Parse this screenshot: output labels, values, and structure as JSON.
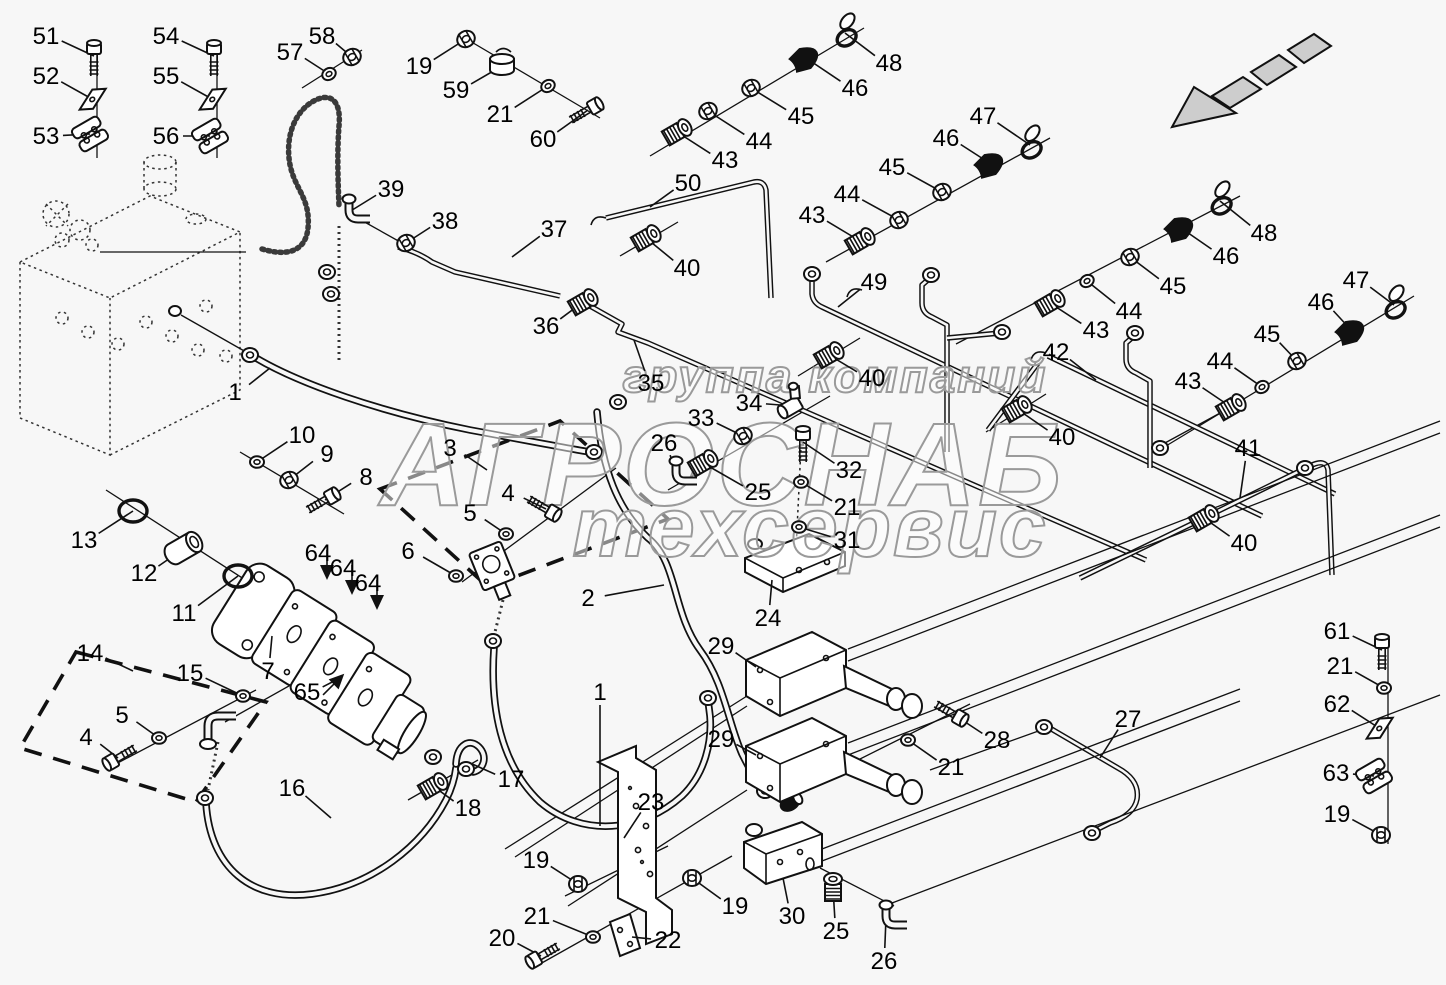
{
  "watermark": {
    "line1": "группа компаний",
    "line2": "АГРОСНАБ",
    "line3": "техсервис",
    "color": "#9a9a9a"
  },
  "colors": {
    "line": "#111111",
    "background": "#f7f7f7",
    "arrow_fill": "#cdcdcd"
  },
  "icons": {
    "direction_arrow": "travel-direction-arrow"
  },
  "callouts": [
    {
      "n": "51",
      "lx": 46,
      "ly": 36,
      "tx": 94,
      "ty": 56,
      "p": "bolt",
      "r": -90
    },
    {
      "n": "52",
      "lx": 46,
      "ly": 76,
      "tx": 92,
      "ty": 99,
      "p": "plate"
    },
    {
      "n": "53",
      "lx": 46,
      "ly": 136,
      "tx": 90,
      "ty": 134,
      "p": "clamp"
    },
    {
      "n": "54",
      "lx": 166,
      "ly": 36,
      "tx": 214,
      "ty": 56,
      "p": "bolt",
      "r": -90
    },
    {
      "n": "55",
      "lx": 166,
      "ly": 76,
      "tx": 212,
      "ty": 99,
      "p": "plate"
    },
    {
      "n": "56",
      "lx": 166,
      "ly": 136,
      "tx": 210,
      "ty": 136,
      "p": "clamp"
    },
    {
      "n": "57",
      "lx": 290,
      "ly": 52,
      "tx": 329,
      "ty": 74,
      "p": "washer"
    },
    {
      "n": "58",
      "lx": 322,
      "ly": 36,
      "tx": 352,
      "ty": 57,
      "p": "nut"
    },
    {
      "n": "19",
      "lx": 419,
      "ly": 66,
      "tx": 466,
      "ty": 39,
      "p": "nut"
    },
    {
      "n": "59",
      "lx": 456,
      "ly": 90,
      "tx": 502,
      "ty": 66,
      "p": "cap",
      "r": 0
    },
    {
      "n": "21",
      "lx": 500,
      "ly": 114,
      "tx": 548,
      "ty": 86,
      "p": "washer"
    },
    {
      "n": "60",
      "lx": 543,
      "ly": 139,
      "tx": 588,
      "ty": 110,
      "p": "bolt"
    },
    {
      "n": "39",
      "lx": 391,
      "ly": 189,
      "tx": 349,
      "ty": 212,
      "p": "elbow",
      "r": 0
    },
    {
      "n": "38",
      "lx": 445,
      "ly": 221,
      "tx": 406,
      "ty": 243,
      "p": "nut"
    },
    {
      "n": "37",
      "lx": 554,
      "ly": 229,
      "tx": 512,
      "ty": 257,
      "p": "none"
    },
    {
      "n": "36",
      "lx": 546,
      "ly": 326,
      "tx": 583,
      "ty": 302,
      "p": "fitting"
    },
    {
      "n": "35",
      "lx": 651,
      "ly": 383,
      "tx": 634,
      "ty": 340,
      "p": "none"
    },
    {
      "n": "50",
      "lx": 688,
      "ly": 183,
      "tx": 650,
      "ty": 207,
      "p": "none"
    },
    {
      "n": "43",
      "lx": 725,
      "ly": 160,
      "tx": 677,
      "ty": 132,
      "p": "fitting"
    },
    {
      "n": "44",
      "lx": 759,
      "ly": 141,
      "tx": 708,
      "ty": 111,
      "p": "nut"
    },
    {
      "n": "45",
      "lx": 801,
      "ly": 116,
      "tx": 751,
      "ty": 88,
      "p": "nut"
    },
    {
      "n": "46",
      "lx": 855,
      "ly": 88,
      "tx": 806,
      "ty": 58,
      "p": "cone"
    },
    {
      "n": "48",
      "lx": 889,
      "ly": 63,
      "tx": 845,
      "ty": 33,
      "p": "ring"
    },
    {
      "n": "40",
      "lx": 687,
      "ly": 268,
      "tx": 646,
      "ty": 238,
      "p": "fitting"
    },
    {
      "n": "43",
      "lx": 812,
      "ly": 215,
      "tx": 860,
      "ty": 241,
      "p": "fitting"
    },
    {
      "n": "44",
      "lx": 847,
      "ly": 194,
      "tx": 899,
      "ty": 220,
      "p": "nut"
    },
    {
      "n": "45",
      "lx": 892,
      "ly": 167,
      "tx": 942,
      "ty": 192,
      "p": "nut"
    },
    {
      "n": "46",
      "lx": 946,
      "ly": 138,
      "tx": 991,
      "ty": 164,
      "p": "cone"
    },
    {
      "n": "47",
      "lx": 983,
      "ly": 116,
      "tx": 1030,
      "ty": 145,
      "p": "ring"
    },
    {
      "n": "49",
      "lx": 874,
      "ly": 282,
      "tx": 838,
      "ty": 307,
      "p": "none"
    },
    {
      "n": "42",
      "lx": 1056,
      "ly": 352,
      "tx": 1096,
      "ty": 380,
      "p": "none"
    },
    {
      "n": "43",
      "lx": 1096,
      "ly": 330,
      "tx": 1050,
      "ty": 303,
      "p": "fitting"
    },
    {
      "n": "44",
      "lx": 1129,
      "ly": 311,
      "tx": 1087,
      "ty": 281,
      "p": "washer"
    },
    {
      "n": "45",
      "lx": 1173,
      "ly": 286,
      "tx": 1130,
      "ty": 257,
      "p": "nut"
    },
    {
      "n": "46",
      "lx": 1226,
      "ly": 256,
      "tx": 1181,
      "ty": 228,
      "p": "cone"
    },
    {
      "n": "48",
      "lx": 1264,
      "ly": 233,
      "tx": 1220,
      "ty": 201,
      "p": "ring"
    },
    {
      "n": "40",
      "lx": 872,
      "ly": 378,
      "tx": 829,
      "ty": 355,
      "p": "fitting"
    },
    {
      "n": "40",
      "lx": 1062,
      "ly": 437,
      "tx": 1017,
      "ty": 409,
      "p": "fitting"
    },
    {
      "n": "41",
      "lx": 1248,
      "ly": 448,
      "tx": 1240,
      "ty": 498,
      "p": "none"
    },
    {
      "n": "43",
      "lx": 1188,
      "ly": 381,
      "tx": 1231,
      "ty": 407,
      "p": "fitting"
    },
    {
      "n": "44",
      "lx": 1220,
      "ly": 361,
      "tx": 1262,
      "ty": 387,
      "p": "washer"
    },
    {
      "n": "45",
      "lx": 1267,
      "ly": 334,
      "tx": 1297,
      "ty": 361,
      "p": "nut"
    },
    {
      "n": "46",
      "lx": 1321,
      "ly": 302,
      "tx": 1352,
      "ty": 331,
      "p": "cone"
    },
    {
      "n": "47",
      "lx": 1356,
      "ly": 280,
      "tx": 1394,
      "ty": 305,
      "p": "ring"
    },
    {
      "n": "40",
      "lx": 1244,
      "ly": 543,
      "tx": 1204,
      "ty": 518,
      "p": "fitting"
    },
    {
      "n": "34",
      "lx": 749,
      "ly": 403,
      "tx": 793,
      "ty": 406,
      "p": "tee"
    },
    {
      "n": "33",
      "lx": 701,
      "ly": 418,
      "tx": 743,
      "ty": 436,
      "p": "nut"
    },
    {
      "n": "26",
      "lx": 664,
      "ly": 443,
      "tx": 676,
      "ty": 474,
      "p": "elbow",
      "r": 0
    },
    {
      "n": "25",
      "lx": 758,
      "ly": 492,
      "tx": 703,
      "ty": 463,
      "p": "fitting"
    },
    {
      "n": "32",
      "lx": 849,
      "ly": 470,
      "tx": 803,
      "ty": 442,
      "p": "bolt",
      "r": -90
    },
    {
      "n": "21",
      "lx": 847,
      "ly": 507,
      "tx": 801,
      "ty": 482,
      "p": "washer",
      "r": 0
    },
    {
      "n": "31",
      "lx": 847,
      "ly": 540,
      "tx": 799,
      "ty": 527,
      "p": "washer",
      "r": 0
    },
    {
      "n": "24",
      "lx": 768,
      "ly": 618,
      "tx": 772,
      "ty": 580,
      "p": "none"
    },
    {
      "n": "29",
      "lx": 721,
      "ly": 646,
      "tx": 756,
      "ty": 667,
      "p": "none"
    },
    {
      "n": "29",
      "lx": 721,
      "ly": 739,
      "tx": 756,
      "ty": 755,
      "p": "none"
    },
    {
      "n": "28",
      "lx": 997,
      "ly": 740,
      "tx": 953,
      "ty": 714,
      "p": "bolt",
      "r": 30
    },
    {
      "n": "21",
      "lx": 951,
      "ly": 767,
      "tx": 908,
      "ty": 740,
      "p": "washer",
      "r": 0
    },
    {
      "n": "27",
      "lx": 1128,
      "ly": 719,
      "tx": 1100,
      "ty": 758,
      "p": "none"
    },
    {
      "n": "2",
      "lx": 588,
      "ly": 598,
      "tx": 664,
      "ty": 585,
      "p": "none"
    },
    {
      "n": "1",
      "lx": 600,
      "ly": 692,
      "tx": 600,
      "ty": 826,
      "p": "none"
    },
    {
      "n": "1",
      "lx": 235,
      "ly": 392,
      "tx": 270,
      "ty": 368,
      "p": "none"
    },
    {
      "n": "3",
      "lx": 450,
      "ly": 448,
      "tx": 487,
      "ty": 470,
      "p": "none"
    },
    {
      "n": "4",
      "lx": 508,
      "ly": 493,
      "tx": 546,
      "ty": 509,
      "p": "bolt",
      "r": 30
    },
    {
      "n": "5",
      "lx": 470,
      "ly": 513,
      "tx": 506,
      "ty": 534,
      "p": "washer",
      "r": 0
    },
    {
      "n": "6",
      "lx": 408,
      "ly": 551,
      "tx": 456,
      "ty": 576,
      "p": "washer",
      "r": 0
    },
    {
      "n": "10",
      "lx": 302,
      "ly": 435,
      "tx": 257,
      "ty": 462,
      "p": "washer",
      "r": 0
    },
    {
      "n": "9",
      "lx": 327,
      "ly": 454,
      "tx": 289,
      "ty": 480,
      "p": "nut"
    },
    {
      "n": "8",
      "lx": 366,
      "ly": 477,
      "tx": 325,
      "ty": 500,
      "p": "bolt"
    },
    {
      "n": "13",
      "lx": 84,
      "ly": 540,
      "tx": 133,
      "ty": 511,
      "p": "oring",
      "r": 0
    },
    {
      "n": "12",
      "lx": 144,
      "ly": 573,
      "tx": 189,
      "ty": 545,
      "p": "coupling"
    },
    {
      "n": "11",
      "lx": 184,
      "ly": 613,
      "tx": 238,
      "ty": 576,
      "p": "oring",
      "r": 0
    },
    {
      "n": "64",
      "lx": 318,
      "ly": 553,
      "tx": 327,
      "ty": 574,
      "p": "arrow",
      "r": 0
    },
    {
      "n": "64",
      "lx": 343,
      "ly": 568,
      "tx": 352,
      "ty": 589,
      "p": "arrow",
      "r": 0
    },
    {
      "n": "64",
      "lx": 368,
      "ly": 583,
      "tx": 377,
      "ty": 604,
      "p": "arrow",
      "r": 0
    },
    {
      "n": "7",
      "lx": 268,
      "ly": 671,
      "tx": 272,
      "ty": 636,
      "p": "none"
    },
    {
      "n": "65",
      "lx": 307,
      "ly": 692,
      "tx": 340,
      "ty": 678,
      "p": "arrow",
      "r": -135
    },
    {
      "n": "14",
      "lx": 90,
      "ly": 653,
      "tx": 133,
      "ty": 671,
      "p": "none"
    },
    {
      "n": "15",
      "lx": 190,
      "ly": 673,
      "tx": 243,
      "ty": 696,
      "p": "washer",
      "r": 0
    },
    {
      "n": "5",
      "lx": 122,
      "ly": 715,
      "tx": 159,
      "ty": 738,
      "p": "washer",
      "r": 0
    },
    {
      "n": "4",
      "lx": 86,
      "ly": 737,
      "tx": 118,
      "ty": 758,
      "p": "bolt",
      "r": 150
    },
    {
      "n": "16",
      "lx": 292,
      "ly": 788,
      "tx": 331,
      "ty": 818,
      "p": "none"
    },
    {
      "n": "17",
      "lx": 511,
      "ly": 779,
      "tx": 470,
      "ty": 763,
      "p": "none"
    },
    {
      "n": "18",
      "lx": 468,
      "ly": 808,
      "tx": 433,
      "ty": 786,
      "p": "fitting"
    },
    {
      "n": "19",
      "lx": 536,
      "ly": 860,
      "tx": 578,
      "ty": 884,
      "p": "nut",
      "r": 0
    },
    {
      "n": "21",
      "lx": 537,
      "ly": 916,
      "tx": 593,
      "ty": 937,
      "p": "washer",
      "r": 0
    },
    {
      "n": "20",
      "lx": 502,
      "ly": 938,
      "tx": 541,
      "ty": 956,
      "p": "bolt",
      "r": 150
    },
    {
      "n": "22",
      "lx": 668,
      "ly": 940,
      "tx": 632,
      "ty": 937,
      "p": "none"
    },
    {
      "n": "23",
      "lx": 651,
      "ly": 802,
      "tx": 624,
      "ty": 838,
      "p": "none"
    },
    {
      "n": "19",
      "lx": 735,
      "ly": 906,
      "tx": 692,
      "ty": 878,
      "p": "nut",
      "r": 0
    },
    {
      "n": "30",
      "lx": 792,
      "ly": 916,
      "tx": 783,
      "ty": 878,
      "p": "none"
    },
    {
      "n": "25",
      "lx": 836,
      "ly": 931,
      "tx": 833,
      "ty": 888,
      "p": "fitting",
      "r": -90
    },
    {
      "n": "26",
      "lx": 884,
      "ly": 961,
      "tx": 886,
      "ty": 918,
      "p": "elbow",
      "r": 0
    },
    {
      "n": "61",
      "lx": 1337,
      "ly": 631,
      "tx": 1382,
      "ty": 650,
      "p": "bolt",
      "r": -90
    },
    {
      "n": "21",
      "lx": 1340,
      "ly": 666,
      "tx": 1384,
      "ty": 688,
      "p": "washer",
      "r": 0
    },
    {
      "n": "62",
      "lx": 1337,
      "ly": 704,
      "tx": 1379,
      "ty": 728,
      "p": "plate"
    },
    {
      "n": "63",
      "lx": 1336,
      "ly": 773,
      "tx": 1374,
      "ty": 776,
      "p": "clamp"
    },
    {
      "n": "19",
      "lx": 1337,
      "ly": 814,
      "tx": 1381,
      "ty": 835,
      "p": "nut",
      "r": 0
    }
  ]
}
